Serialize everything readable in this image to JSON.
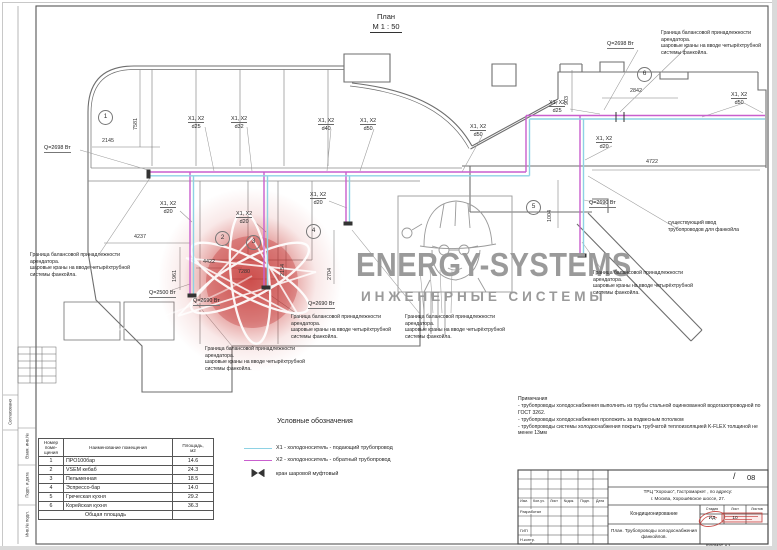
{
  "sheet": {
    "plan_title": "План",
    "plan_scale": "М 1 : 50",
    "format_label": "Формат А3"
  },
  "watermark": {
    "brand": "ENERGY-SYSTEMS",
    "subtitle": "ИНЖЕНЕРНЫЕ СИСТЕМЫ",
    "gray": "#9a9a9a",
    "logo_red": "#b92a25"
  },
  "colors": {
    "pipe_supply_x1": "#8ed2e4",
    "pipe_return_x2": "#c95fce",
    "wall": "#6e6e6e"
  },
  "plan": {
    "pipe_labels": [
      {
        "t": "X1, X2",
        "d": "d25"
      },
      {
        "t": "X1, X2",
        "d": "d32"
      },
      {
        "t": "X1, X2",
        "d": "d40"
      },
      {
        "t": "X1, X2",
        "d": "d50"
      },
      {
        "t": "X1, X2",
        "d": "d50"
      },
      {
        "t": "X1, X2",
        "d": "d20"
      },
      {
        "t": "X1, X2",
        "d": "d20"
      },
      {
        "t": "X1, X2",
        "d": "d20"
      },
      {
        "t": "X1, X2",
        "d": "d25"
      },
      {
        "t": "X1, X2",
        "d": "d20"
      },
      {
        "t": "X1, X2",
        "d": "d50"
      }
    ],
    "q_labels": [
      "Q=2698 Вт",
      "Q=2698 Вт",
      "Q=2500 Вт",
      "Q=2690 Вт",
      "Q=2690 Вт",
      "Q=2690 Вт"
    ],
    "dims": [
      "2145",
      "7581",
      "4237",
      "1961",
      "4422",
      "7280",
      "2154",
      "2704",
      "903",
      "2842",
      "4722",
      "1004"
    ],
    "axis_bubbles": [
      "1",
      "2",
      "3",
      "4",
      "5",
      "6"
    ],
    "boundary_note": {
      "l1": "Граница балансовой принадлежности",
      "l2": "арендатора.",
      "l3": "шаровые краны на вводе четырёхтрубной",
      "l4": "системы фанкойла."
    },
    "existing_note": {
      "l1": "существующий ввод",
      "l2": "трубопроводов для фанкойла"
    }
  },
  "legend": {
    "title": "Условные обозначения",
    "x1": "Х1 - холодоноситель - подающий трубопровод",
    "x2": "Х2 - холодоноситель - обратный трубопровод",
    "valve": "кран шаровой муфтовый"
  },
  "notes": {
    "title": "Примечания",
    "items": [
      "- трубопроводы холодоснабжения выполнить из трубы стальной оцинкованной водогазопроводной по ГОСТ 3262.",
      "- трубопроводы холодоснабжения проложить за подвесным потолком",
      "- трубопроводы системы холодоснабжения покрыть трубчатой теплоизоляцией K-FLEX толщиной не менее 13мм"
    ]
  },
  "rooms": {
    "headers": [
      "Номер\nпоме-\nщения",
      "Наименование помещения",
      "Площадь,\nм2"
    ],
    "rows": [
      [
        "1",
        "ПРО100бар",
        "14.6"
      ],
      [
        "2",
        "VSEM кебаб",
        "24.3"
      ],
      [
        "3",
        "Пельменная",
        "18.5"
      ],
      [
        "4",
        "Эспрессо-бар",
        "14.0"
      ],
      [
        "5",
        "Греческая кухня",
        "29.2"
      ],
      [
        "6",
        "Корейская кухня",
        "36.3"
      ]
    ],
    "footer": {
      "label": "Общая площадь",
      "value": ""
    }
  },
  "titleblock": {
    "rev_headers": [
      "Изм.",
      "Кол.уч.",
      "Лист",
      "№док.",
      "Подп.",
      "Дата"
    ],
    "roles": [
      "Разработал",
      "ГИП",
      "Н.контр."
    ],
    "doc_slash": "/",
    "doc_number": "08",
    "project_line1": "ТРЦ \"Хорошо\", Гастромаркет        , по адресу:",
    "project_line2": "г. Москва, Хорошёвское шоссе, 27.",
    "section": "Кондиционирование",
    "stage_headers": [
      "Стадия",
      "Лист",
      "Листов"
    ],
    "stage_values": [
      "ИД",
      "10",
      ""
    ],
    "drawing_title": "План. Трубопроводы холодоснабжения фанкойлов."
  },
  "side_strip": [
    "Согласовано",
    "Взам. инв.№",
    "Подп. и дата",
    "Инв.№ подл."
  ]
}
